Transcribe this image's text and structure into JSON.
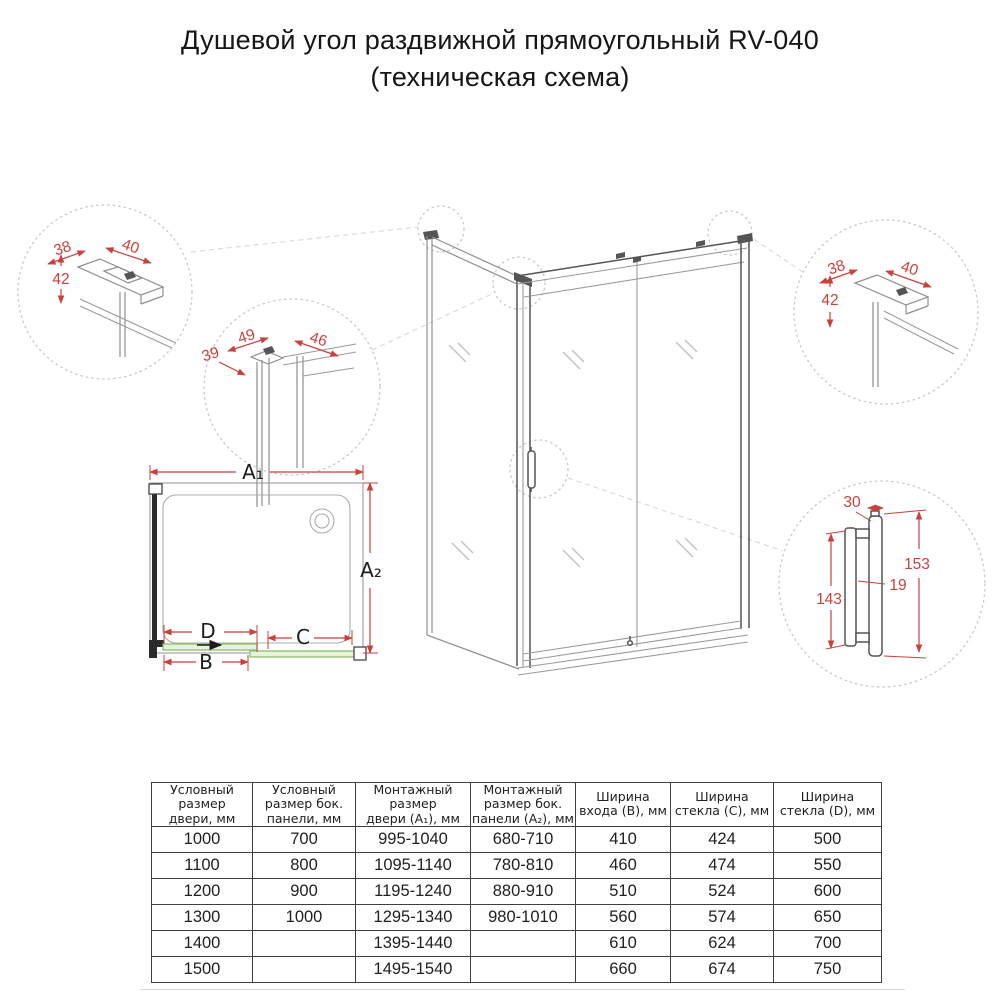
{
  "title": {
    "line1": "Душевой угол раздвижной прямоугольный RV-040",
    "line2": "(техническая схема)"
  },
  "colors": {
    "dimension_red": "#c9413d",
    "glass_green_stroke": "#8fbe6e",
    "glass_green_fill": "#e7f2dd"
  },
  "diagram": {
    "detail_top_left": {
      "dims": [
        "38",
        "40",
        "42"
      ]
    },
    "detail_mid_left": {
      "dims": [
        "39",
        "49",
        "46"
      ]
    },
    "detail_top_right": {
      "dims": [
        "38",
        "40",
        "42"
      ]
    },
    "detail_handle": {
      "dims": [
        "30",
        "153",
        "19",
        "143"
      ]
    },
    "plan": {
      "a1": "A₁",
      "a2": "A₂",
      "d": "D",
      "c": "C",
      "b": "B"
    }
  },
  "table": {
    "headers": [
      "Условный\nразмер\nдвери, мм",
      "Условный\nразмер бок.\nпанели, мм",
      "Монтажный\nразмер\nдвери (A₁), мм",
      "Монтажный\nразмер бок.\nпанели (A₂), мм",
      "Ширина\nвхода (B), мм",
      "Ширина\nстекла (C), мм",
      "Ширина\nстекла (D), мм"
    ],
    "rows": [
      [
        "1000",
        "700",
        "995-1040",
        "680-710",
        "410",
        "424",
        "500"
      ],
      [
        "1100",
        "800",
        "1095-1140",
        "780-810",
        "460",
        "474",
        "550"
      ],
      [
        "1200",
        "900",
        "1195-1240",
        "880-910",
        "510",
        "524",
        "600"
      ],
      [
        "1300",
        "1000",
        "1295-1340",
        "980-1010",
        "560",
        "574",
        "650"
      ],
      [
        "1400",
        "",
        "1395-1440",
        "",
        "610",
        "624",
        "700"
      ],
      [
        "1500",
        "",
        "1495-1540",
        "",
        "660",
        "674",
        "750"
      ]
    ]
  }
}
